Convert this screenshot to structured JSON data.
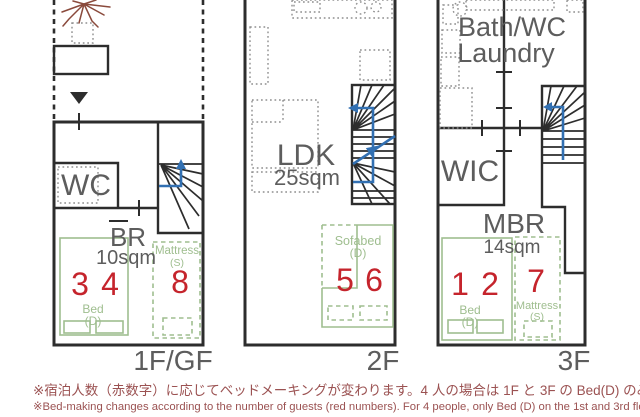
{
  "colors": {
    "wall": "#2d2d2d",
    "room_label": "#5d5d5d",
    "bed_green": "#9fbe8f",
    "number_red": "#c5242c",
    "arrow_blue": "#3270b2",
    "note_red": "#9b5252",
    "tree_brown": "#8a4a3c",
    "furniture_gray": "#8f8f8f"
  },
  "floors": {
    "f1": {
      "floor_label": "1F/GF",
      "wc": "WC",
      "br": "BR",
      "br_size": "10sqm",
      "bed": "Bed",
      "bed_type": "(D)",
      "mattress": "Mattress",
      "mattress_size": "(S)",
      "guests": {
        "a": "3",
        "b": "4",
        "c": "8"
      }
    },
    "f2": {
      "floor_label": "2F",
      "ldk": "LDK",
      "ldk_size": "25sqm",
      "sofabed": "Sofabed",
      "sofabed_type": "(D)",
      "guests": {
        "a": "5",
        "b": "6"
      }
    },
    "f3": {
      "floor_label": "3F",
      "bath": "Bath/WC",
      "laundry": "Laundry",
      "wic": "WIC",
      "mbr": "MBR",
      "mbr_size": "14sqm",
      "bed": "Bed",
      "bed_type": "(D)",
      "mattress": "Mattress",
      "mattress_size": "(S)",
      "guests": {
        "a": "1",
        "b": "2",
        "c": "7"
      }
    }
  },
  "notes": {
    "japanese": "※宿泊人数（赤数字）に応じてベッドメーキングが変わります。4 人の場合は 1F と 3F の Bed(D) のみ。",
    "english": "※Bed-making changes according to the number of guests (red numbers). For 4 people, only Bed (D) on the 1st and 3rd floors."
  }
}
